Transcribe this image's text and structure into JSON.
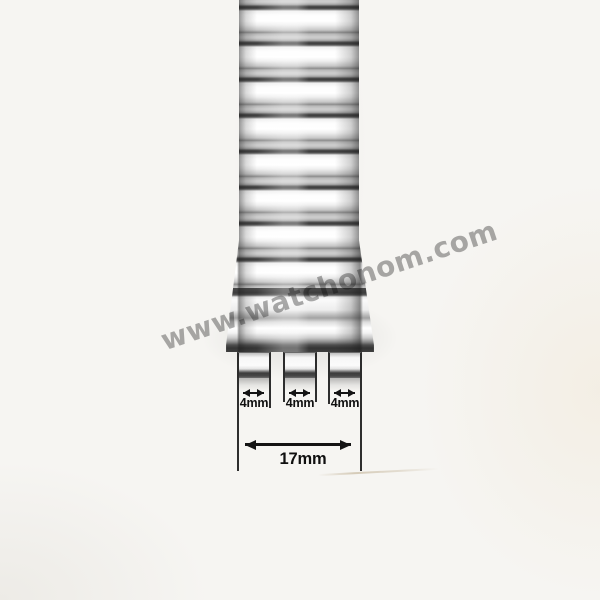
{
  "photo": {
    "subject": "stainless-steel-watch-band-end-piece",
    "background_color": "#f6f5f2"
  },
  "watermark": {
    "text": "www.watchonom.com",
    "color": "#8f8f8f"
  },
  "band": {
    "highlight_color": "#ffffff",
    "metal_mid_color": "#c6c6c6",
    "separator_color": "#4a4a4a",
    "visible_link_separators": 9,
    "prong_count": 3
  },
  "measurements": {
    "annotation_color": "#141414",
    "prong_widths": [
      {
        "label": "4mm"
      },
      {
        "label": "4mm"
      },
      {
        "label": "4mm"
      }
    ],
    "total_width": {
      "label": "17mm"
    }
  }
}
